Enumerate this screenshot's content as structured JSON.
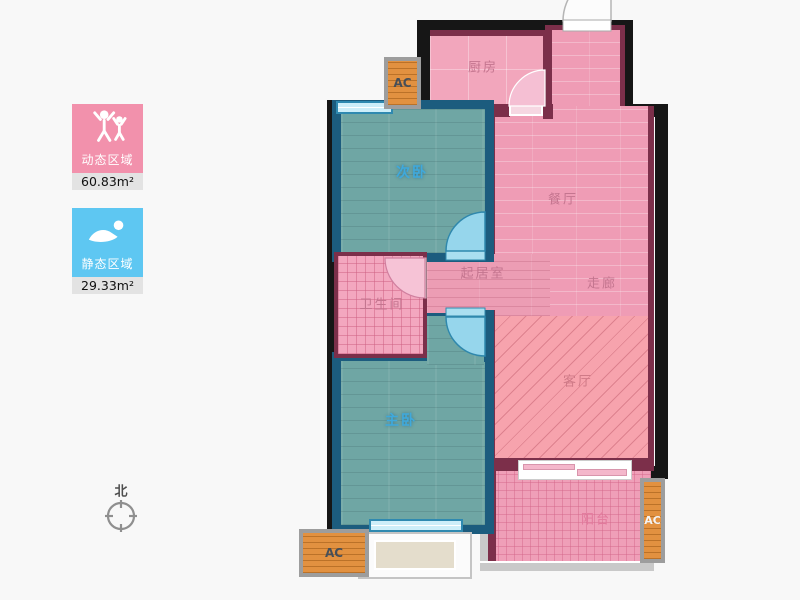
{
  "legend": {
    "dynamic": {
      "label": "动态区域",
      "value": "60.83m²",
      "color": "#f291ac",
      "icon": "people-raising-arms-icon"
    },
    "static": {
      "label": "静态区域",
      "value": "29.33m²",
      "color": "#5ec7f2",
      "icon": "resting-person-icon"
    }
  },
  "compass": {
    "label": "北"
  },
  "rooms": {
    "kitchen": {
      "label": "厨房"
    },
    "dining": {
      "label": "餐厅"
    },
    "corridor": {
      "label": "走廊"
    },
    "inner_living": {
      "label": "起居室"
    },
    "bathroom": {
      "label": "卫生间"
    },
    "living": {
      "label": "客厅"
    },
    "balcony": {
      "label": "阳台"
    },
    "second_bedroom": {
      "label": "次卧"
    },
    "master_bedroom": {
      "label": "主卧"
    }
  },
  "ac_units": {
    "kitchen_side": "AC",
    "master_side": "AC",
    "balcony_side": "AC"
  },
  "palette": {
    "floor_pink": "#ef9cb5",
    "floor_teal": "#6fa6a4",
    "living_salmon": "#f7a3ad",
    "wall_black": "#161616",
    "wall_maroon": "#7c2f4a",
    "bedroom_wall_blue": "#1c5c7e",
    "ac_orange": "#e29140",
    "window_blue": "#cdeef9",
    "legend_value_bg": "#e3e3e3"
  }
}
